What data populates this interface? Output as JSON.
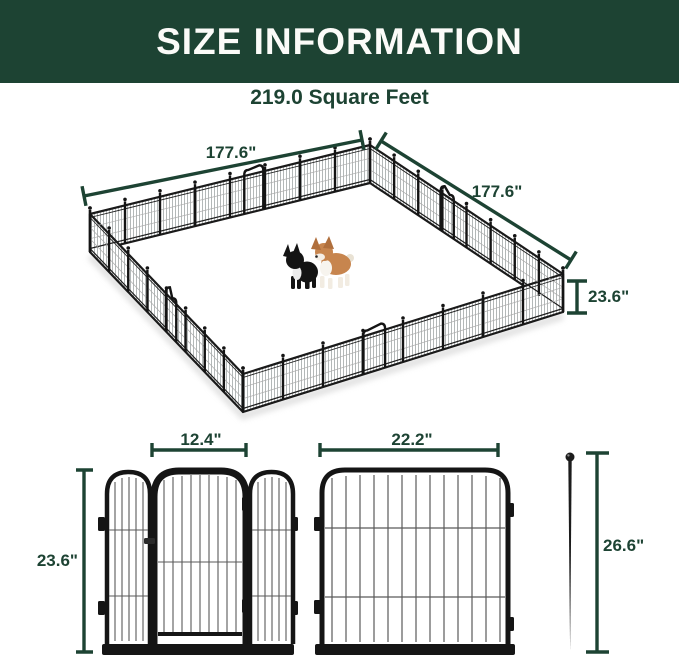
{
  "header": {
    "title": "SIZE INFORMATION"
  },
  "subtitle": {
    "area": "219.0 Square Feet"
  },
  "pen": {
    "dim_back_left": "177.6\"",
    "dim_back_right": "177.6\"",
    "dim_height": "23.6\""
  },
  "door_panel": {
    "door_width": "12.4\"",
    "height": "23.6\""
  },
  "panel": {
    "width": "22.2\""
  },
  "stake": {
    "height": "26.6\""
  },
  "colors": {
    "banner_green": "#1d4333",
    "dimension_green": "#1d4333",
    "frame_black": "#151515",
    "mesh_gray": "#9aa0a0",
    "corgi_tan": "#c7854e",
    "bulldog_black": "#141414"
  }
}
